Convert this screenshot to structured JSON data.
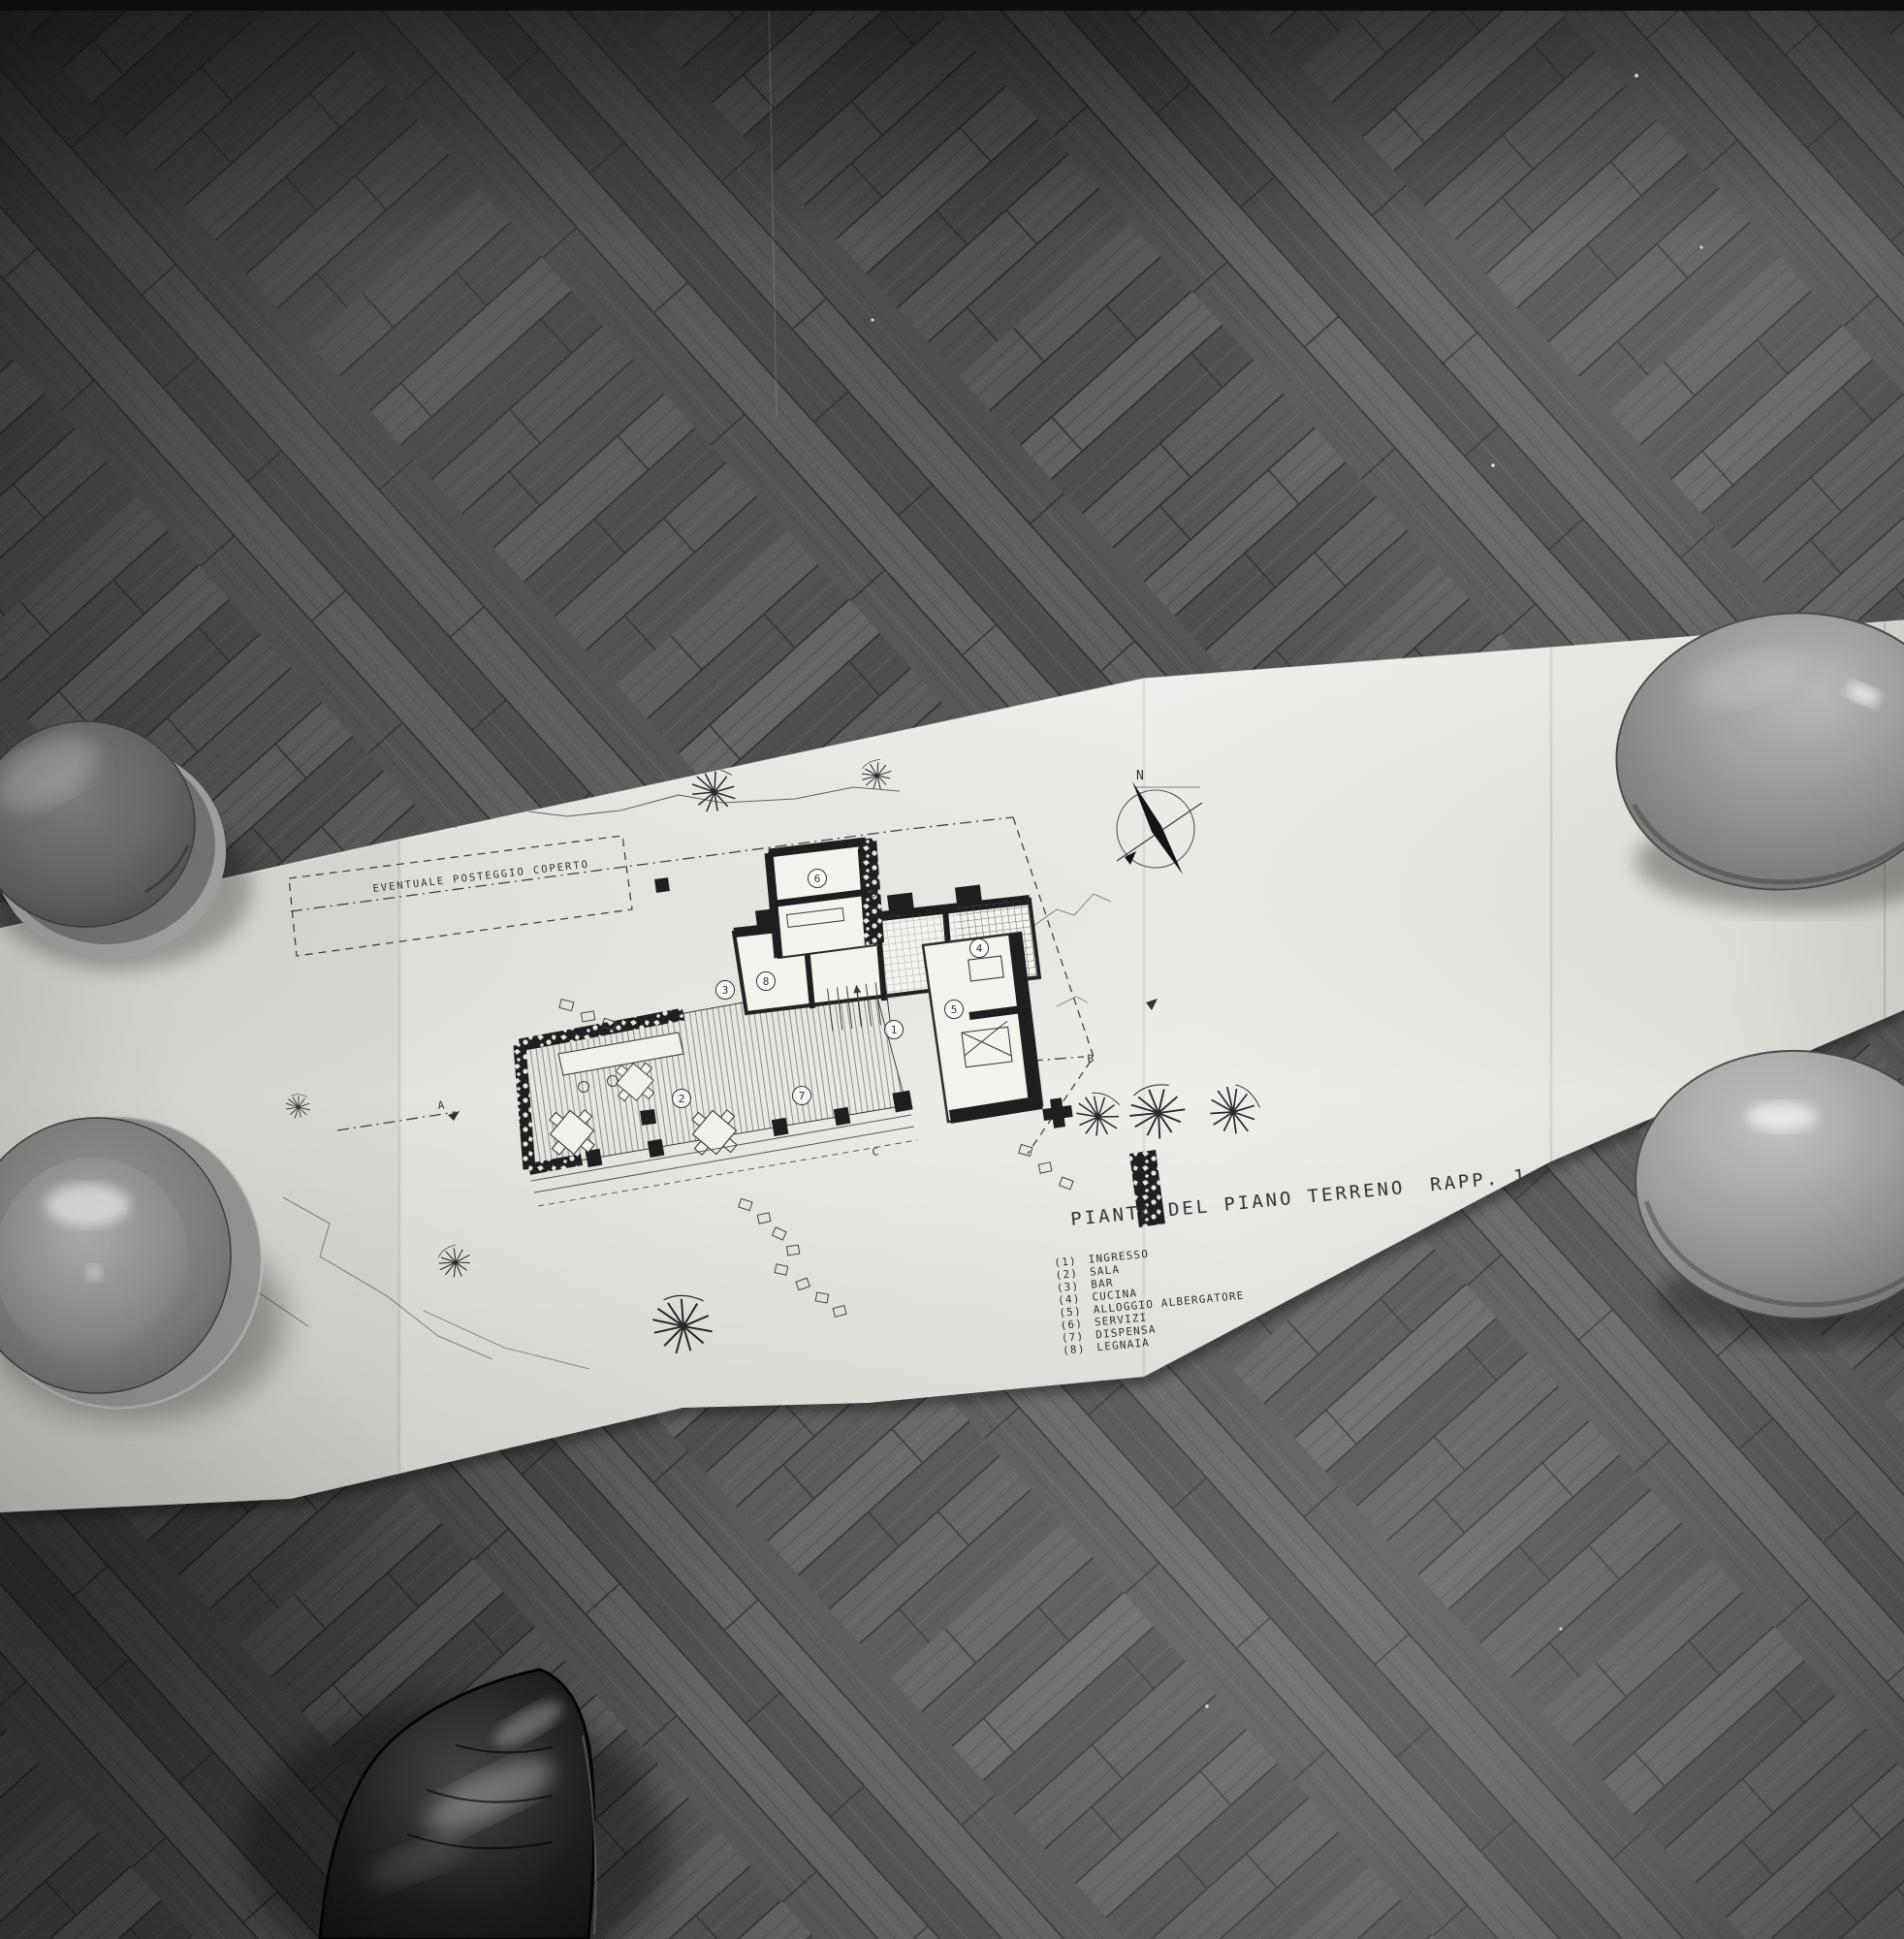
{
  "photo": {
    "description": "Black-and-white photograph of an architect's ground-floor plan unfolded on a herringbone parquet floor, held down by two dark plates (left) and two glossy stones (right), with the photographer's black leather shoe at bottom center",
    "colors": {
      "floor_dark": "#3b3b3b",
      "floor_light": "#8f8f8f",
      "paper": "#e9e7e2",
      "ink": "#2e2e2e",
      "plate": "#5f5f5f",
      "stone": "#9a9a9a",
      "shoe": "#151515"
    }
  },
  "plan": {
    "title": "PIANTA DEL PIANO TERRENO",
    "scale_label": "RAPP. 1:100",
    "site_note": "EVENTUALE POSTEGGIO COPERTO",
    "compass": "N",
    "sections": {
      "a": "A",
      "b": "B",
      "c": "C",
      "d": "D"
    },
    "rooms": [
      {
        "num": "1",
        "mark": "(1)",
        "label": "INGRESSO"
      },
      {
        "num": "2",
        "mark": "(2)",
        "label": "SALA"
      },
      {
        "num": "3",
        "mark": "(3)",
        "label": "BAR"
      },
      {
        "num": "4",
        "mark": "(4)",
        "label": "CUCINA"
      },
      {
        "num": "5",
        "mark": "(5)",
        "label": "ALLOGGIO ALBERGATORE"
      },
      {
        "num": "6",
        "mark": "(6)",
        "label": "SERVIZI"
      },
      {
        "num": "7",
        "mark": "(7)",
        "label": "DISPENSA"
      },
      {
        "num": "8",
        "mark": "(8)",
        "label": "LEGNAIA"
      }
    ]
  }
}
